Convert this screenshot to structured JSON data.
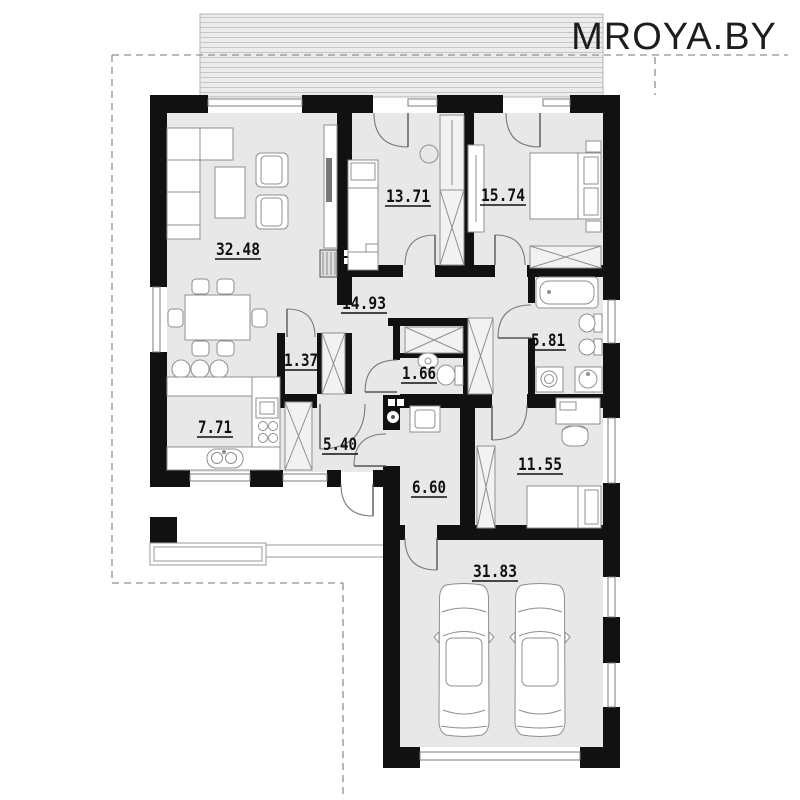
{
  "watermark": {
    "text": "MROYA.BY"
  },
  "plan": {
    "rooms": [
      {
        "id": "living-room",
        "area": "32.48"
      },
      {
        "id": "bedroom-1",
        "area": "13.71"
      },
      {
        "id": "bedroom-2",
        "area": "15.74"
      },
      {
        "id": "hall",
        "area": "14.93"
      },
      {
        "id": "pantry",
        "area": "1.37"
      },
      {
        "id": "wc",
        "area": "1.66"
      },
      {
        "id": "bathroom",
        "area": "5.81"
      },
      {
        "id": "kitchen",
        "area": "7.71"
      },
      {
        "id": "mudroom",
        "area": "5.40"
      },
      {
        "id": "boiler-room",
        "area": "6.60"
      },
      {
        "id": "bedroom-3",
        "area": "11.55"
      },
      {
        "id": "garage",
        "area": "31.83"
      }
    ],
    "garage_cars": 2,
    "colors": {
      "walls": "#111111",
      "floor": "#e8e8e8",
      "furniture_outline": "#8f8f8f",
      "dashed_boundary": "#909090",
      "watermark": "#1d1d1d"
    }
  }
}
